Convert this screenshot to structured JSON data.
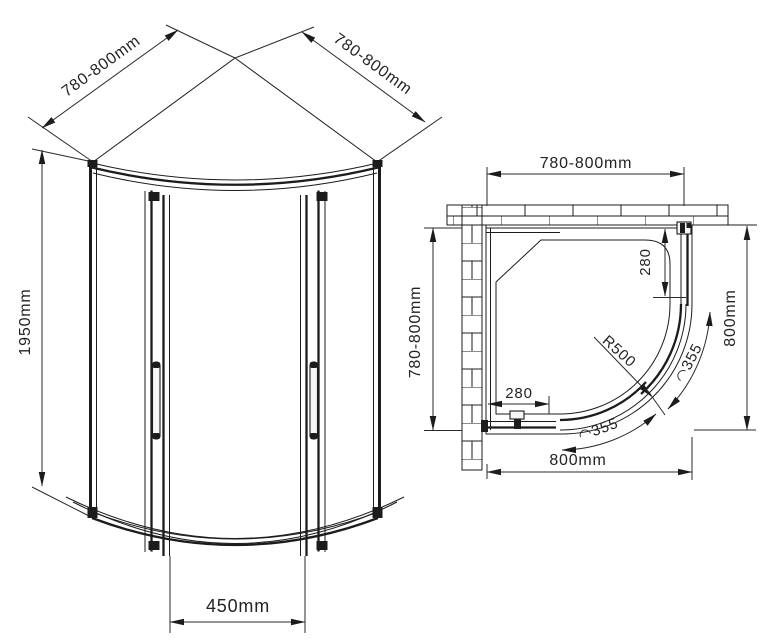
{
  "drawing": {
    "type": "quadrant-shower-enclosure-technical-drawing",
    "colors": {
      "line": "#1c1c1c",
      "background": "#ffffff"
    },
    "front_view": {
      "width_left": "780-800mm",
      "width_right": "780-800mm",
      "height": "1950mm",
      "door_opening": "450mm"
    },
    "plan_view": {
      "width_top": "780-800mm",
      "depth_left": "780-800mm",
      "depth_right": "800mm",
      "width_bottom": "800mm",
      "panel_inset_right": "280",
      "panel_inset_bottom": "280",
      "corner_radius": "R500",
      "door_arc_upper": "◠355",
      "door_arc_lower": "◠355"
    }
  }
}
